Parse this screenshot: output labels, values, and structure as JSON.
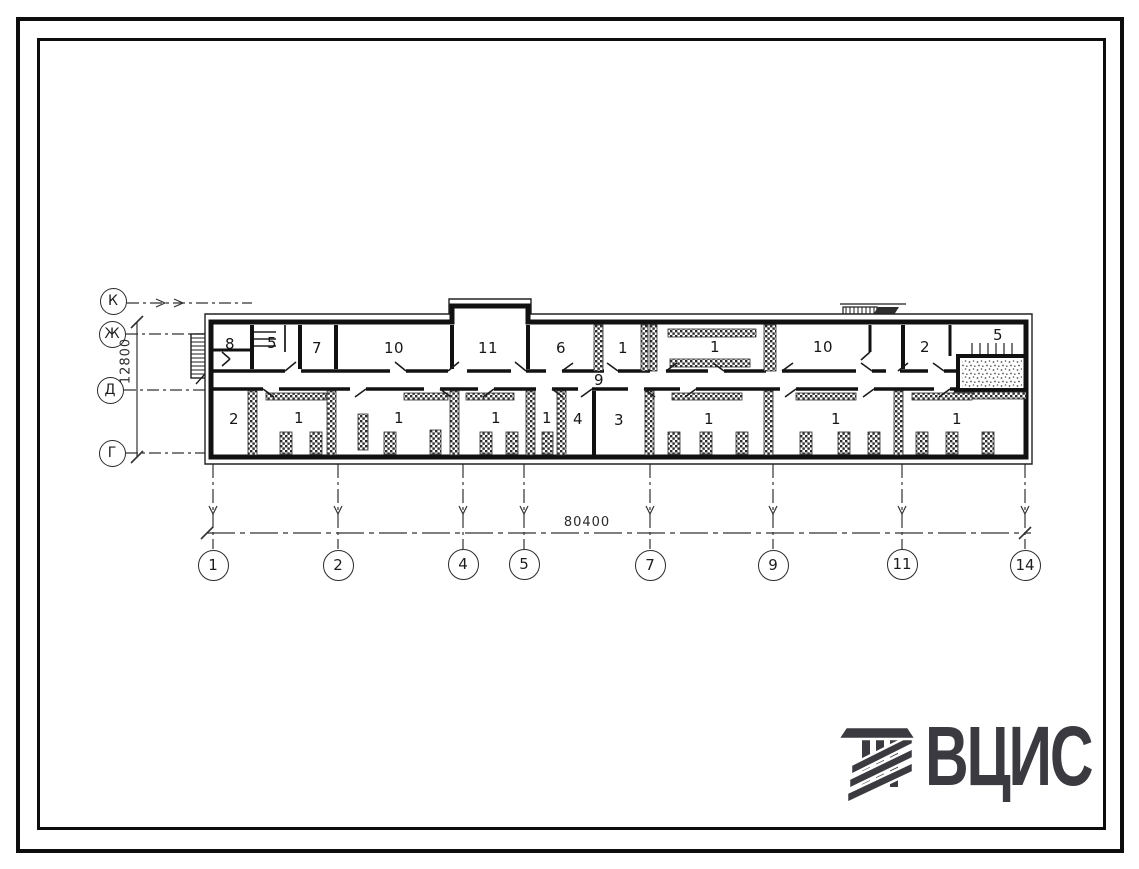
{
  "sheet": {
    "background": "#ffffff",
    "line_color": "#1c1c1c"
  },
  "plan": {
    "rooms": [
      {
        "label": "8",
        "x": 230,
        "y": 344
      },
      {
        "label": "5",
        "x": 272,
        "y": 343
      },
      {
        "label": "7",
        "x": 317,
        "y": 348
      },
      {
        "label": "10",
        "x": 394,
        "y": 348
      },
      {
        "label": "11",
        "x": 488,
        "y": 348
      },
      {
        "label": "6",
        "x": 561,
        "y": 348
      },
      {
        "label": "1",
        "x": 623,
        "y": 348
      },
      {
        "label": "1",
        "x": 715,
        "y": 347
      },
      {
        "label": "10",
        "x": 823,
        "y": 347
      },
      {
        "label": "2",
        "x": 925,
        "y": 347
      },
      {
        "label": "5",
        "x": 998,
        "y": 335
      },
      {
        "label": "9",
        "x": 599,
        "y": 380
      },
      {
        "label": "2",
        "x": 234,
        "y": 419
      },
      {
        "label": "1",
        "x": 299,
        "y": 418
      },
      {
        "label": "1",
        "x": 399,
        "y": 418
      },
      {
        "label": "1",
        "x": 496,
        "y": 418
      },
      {
        "label": "1",
        "x": 547,
        "y": 418
      },
      {
        "label": "4",
        "x": 578,
        "y": 419
      },
      {
        "label": "3",
        "x": 619,
        "y": 420
      },
      {
        "label": "1",
        "x": 709,
        "y": 419
      },
      {
        "label": "1",
        "x": 836,
        "y": 419
      },
      {
        "label": "1",
        "x": 957,
        "y": 419
      }
    ]
  },
  "axes": {
    "left": [
      {
        "label": "К",
        "x": 113,
        "y": 301
      },
      {
        "label": "Ж",
        "x": 112,
        "y": 334
      },
      {
        "label": "Д",
        "x": 110,
        "y": 390
      },
      {
        "label": "Г",
        "x": 112,
        "y": 453
      }
    ],
    "bottom": [
      {
        "label": "1",
        "x": 213,
        "y": 565
      },
      {
        "label": "2",
        "x": 338,
        "y": 565
      },
      {
        "label": "4",
        "x": 463,
        "y": 564
      },
      {
        "label": "5",
        "x": 524,
        "y": 564
      },
      {
        "label": "7",
        "x": 650,
        "y": 565
      },
      {
        "label": "9",
        "x": 773,
        "y": 565
      },
      {
        "label": "11",
        "x": 902,
        "y": 564
      },
      {
        "label": "14",
        "x": 1025,
        "y": 565
      }
    ]
  },
  "dimensions": {
    "building_length": {
      "value": "80400"
    },
    "building_width": {
      "value": "12800"
    }
  },
  "logo": {
    "text": "ВЦИС",
    "color": "#3a3a40"
  }
}
